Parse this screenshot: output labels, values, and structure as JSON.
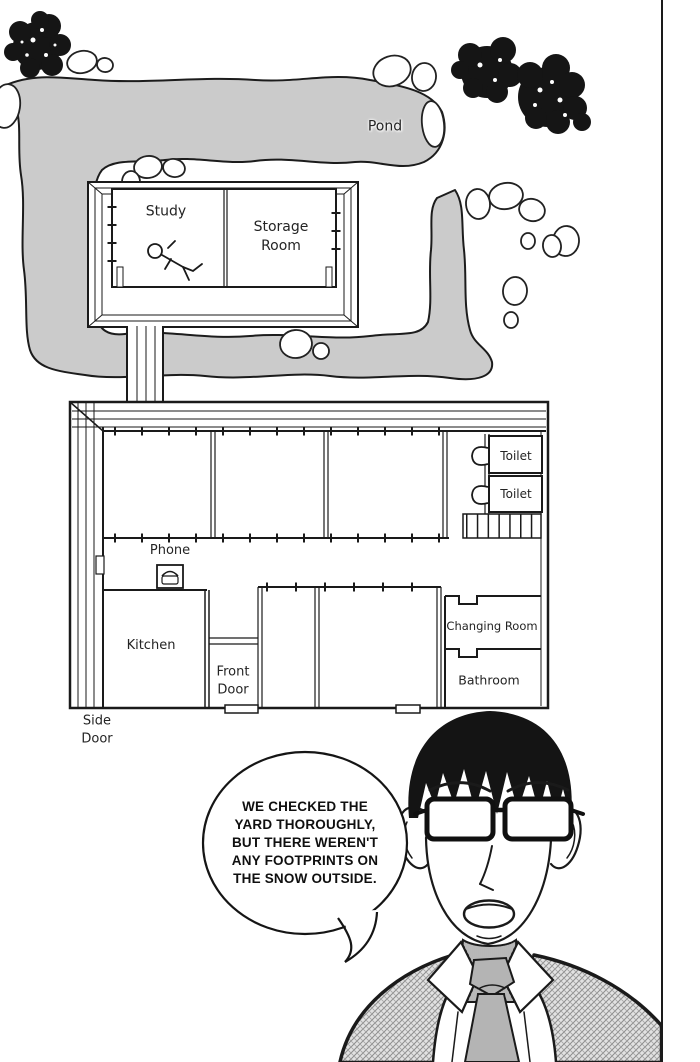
{
  "colors": {
    "pond": "#cbcbcb",
    "tie": "#b4b4b4",
    "line": "#1a1a1a",
    "suit_base": "#dedede"
  },
  "map": {
    "pond_label": "Pond",
    "study_label": "Study",
    "storage_room_label": "Storage\nRoom",
    "toilet_label_top": "Toilet",
    "toilet_label_bottom": "Toilet",
    "phone_label": "Phone",
    "kitchen_label": "Kitchen",
    "front_door_label": "Front\nDoor",
    "side_door_label": "Side\nDoor",
    "changing_room_label": "Changing Room",
    "bathroom_label": "Bathroom",
    "icons": {
      "phone": "phone-icon",
      "toilet_top": "toilet-icon",
      "toilet_bottom": "toilet-icon",
      "victim": "fallen-person-icon"
    }
  },
  "speech_bubble": {
    "text": "WE CHECKED THE\nYARD THOROUGHLY,\nBUT THERE WEREN'T\nANY FOOTPRINTS ON\nTHE SNOW OUTSIDE."
  }
}
